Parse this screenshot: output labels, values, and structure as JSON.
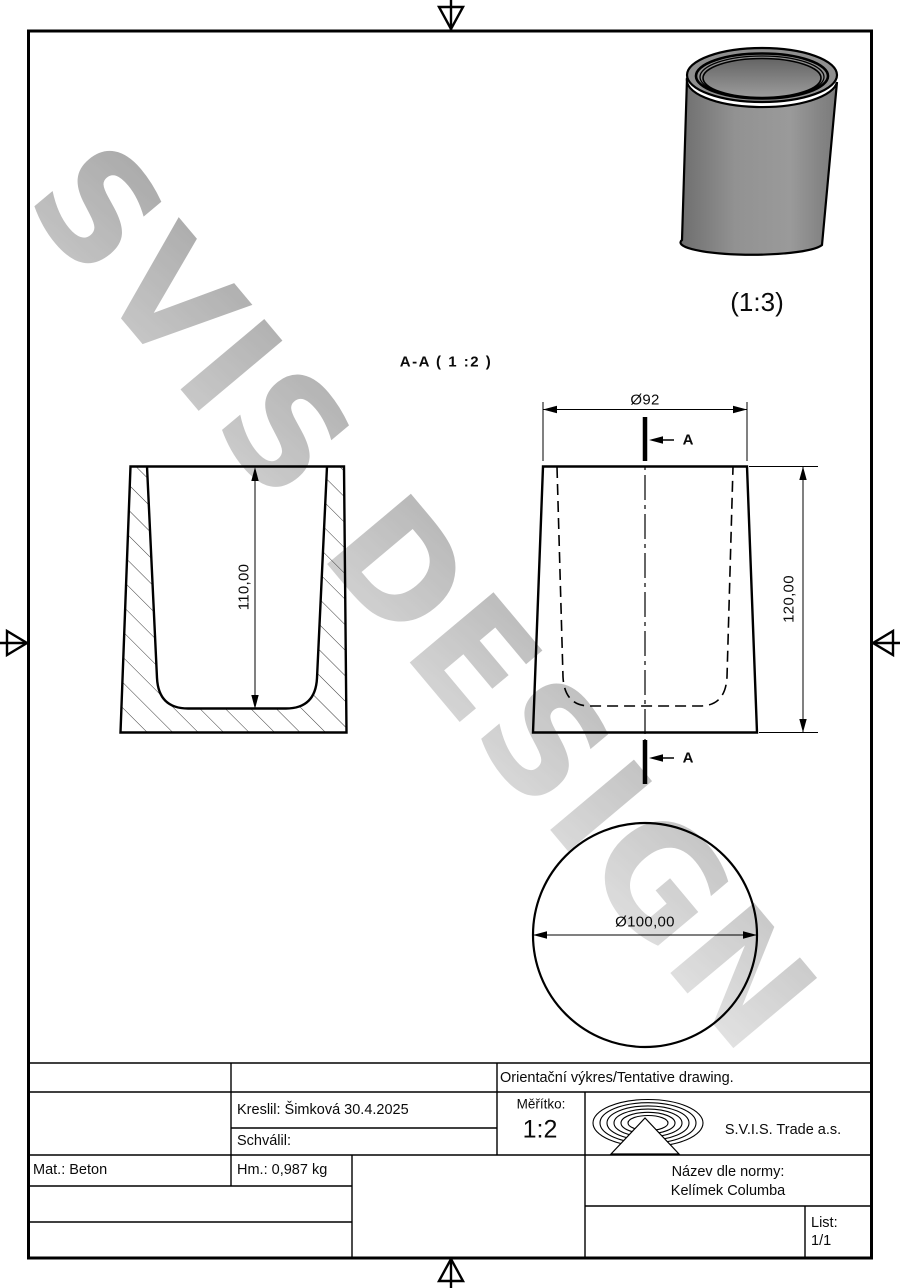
{
  "watermark": {
    "text": "SVIS DESIGN"
  },
  "colors": {
    "line": "#000000",
    "cup_gray": "#8a8a8a",
    "watermark_start": "#8f8f8f",
    "watermark_end": "#e4e4e4"
  },
  "iso_view": {
    "scale_label": "(1:3)"
  },
  "section_view": {
    "title": "A-A ( 1 :2 )",
    "depth_dim": "110,00"
  },
  "front_view": {
    "top_diameter_dim": "Ø92",
    "height_dim": "120,00",
    "cut_label": "A"
  },
  "bottom_view": {
    "diameter_dim": "Ø100,00"
  },
  "title_block": {
    "tentative_note": "Orientační výkres/Tentative drawing.",
    "drawn_by": "Kreslil: Šimková 30.4.2025",
    "approved_by": "Schválil:",
    "scale_label": "Měřítko:",
    "scale_value": "1:2",
    "company": "S.V.I.S. Trade a.s.",
    "material": "Mat.: Beton",
    "weight": "Hm.: 0,987 kg",
    "norm_name_label": "Název dle normy:",
    "norm_name_value": "Kelímek Columba",
    "sheet_label": "List:",
    "sheet_value": "1/1"
  }
}
